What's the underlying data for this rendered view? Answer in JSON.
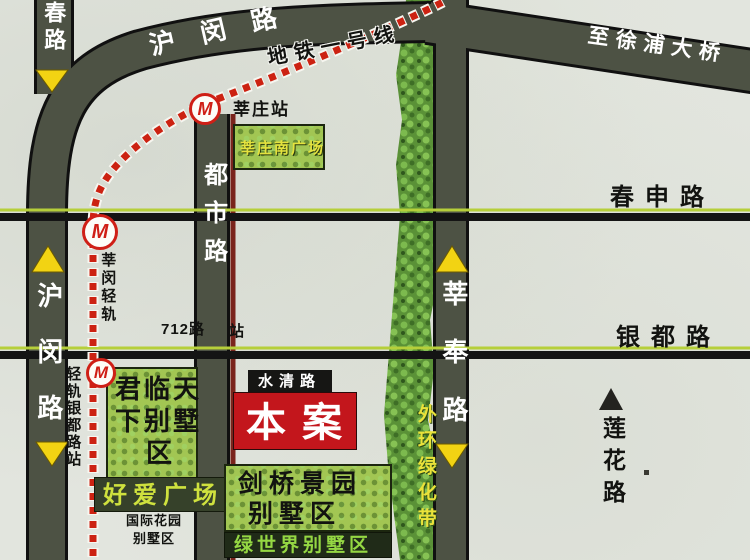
{
  "roads": {
    "humin": "沪闵路",
    "humin_top": "沪闵路",
    "zhongchun": "中春路",
    "dushi": "都市路",
    "xinfeng": "莘奉路",
    "chunshen": "春申路",
    "yindu": "银都路",
    "lianhua": "莲花路",
    "xupu_bridge": "至徐浦大桥"
  },
  "metro": {
    "line1_label": "地铁一号线",
    "lightrail_label": "莘闵轻轨",
    "yindu_station": "轻轨银都路站",
    "xinzhuang_station": "莘庄站",
    "station_symbol": "M"
  },
  "places": {
    "south_plaza": "莘庄南广场",
    "junlin_row1": "君临天",
    "junlin_row2": "下别墅",
    "junlin_row3": "区",
    "haoai_plaza": "好爱广场",
    "intl_row1": "国际花园",
    "intl_row2": "别墅区",
    "benan": "本案",
    "shuiqing": "水清路",
    "jianqiao_row1": "剑桥景园",
    "jianqiao_row2": "别墅区",
    "lvshijie": "绿世界别墅区",
    "greenbelt": "外环绿化带",
    "bus_712": "712路",
    "bus_stop": "站"
  },
  "colors": {
    "road_fill": "#4d5244",
    "metro_dot_red": "#cc2212",
    "highlight_red": "#c3161c",
    "green_box": "#a2c653",
    "arrow_yellow": "#f2d313"
  }
}
